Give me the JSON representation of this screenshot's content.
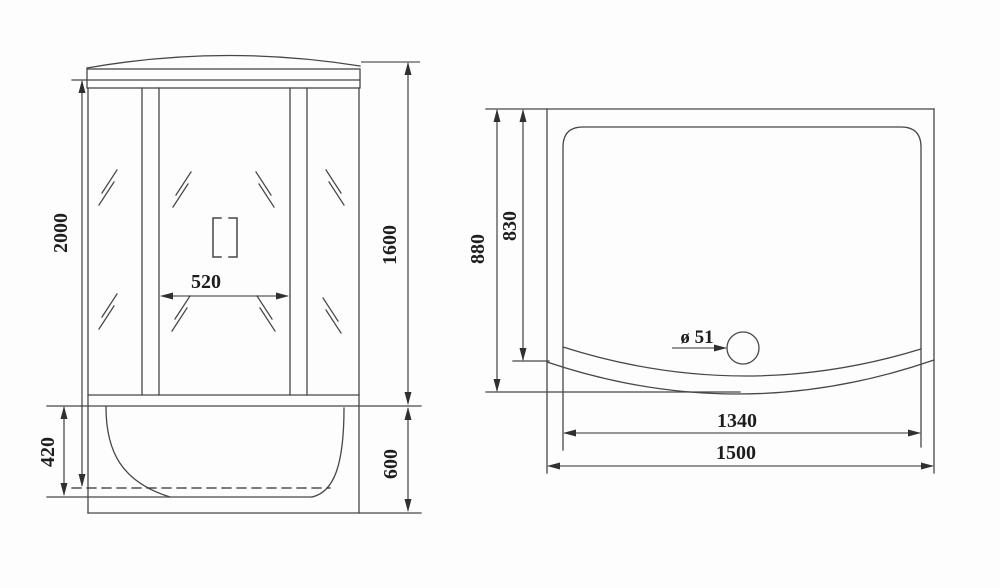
{
  "drawing": {
    "front_view": {
      "height_total": "2000",
      "tray_inner_depth": "420",
      "door_opening_width": "520",
      "glass_section_height": "1600",
      "tray_section_height": "600"
    },
    "top_view": {
      "depth_outer": "880",
      "depth_inner": "830",
      "drain_diameter": "ø 51",
      "width_inner": "1340",
      "width_outer": "1500"
    },
    "colors": {
      "line": "#474747",
      "dimension_line": "#303030",
      "text": "#1d1d1d",
      "background": "#fdfdfd"
    }
  }
}
